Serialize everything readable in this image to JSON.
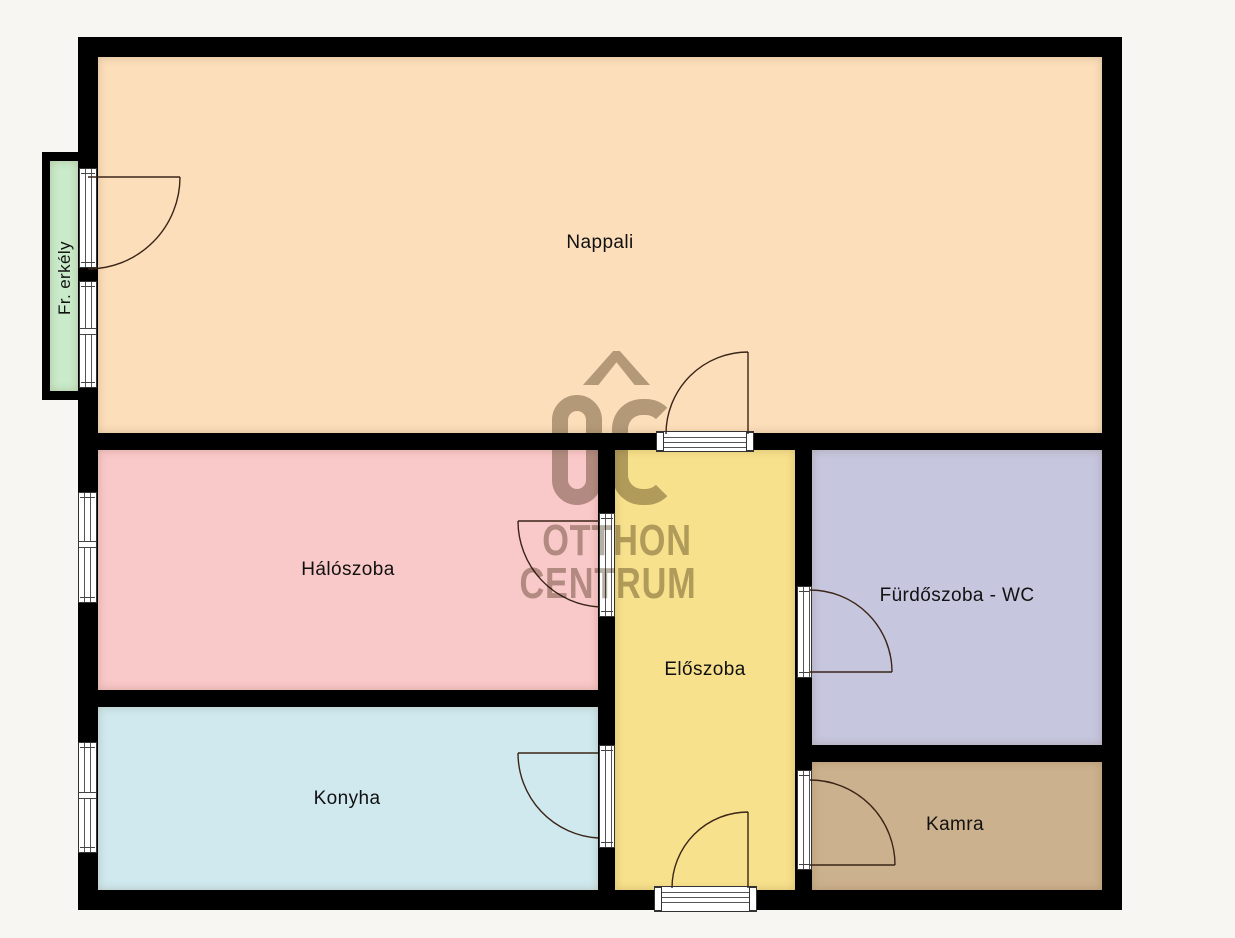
{
  "plan": {
    "type": "apartment floor plan",
    "rooms": [
      {
        "id": "nappali",
        "label": "Nappali",
        "color": "#fcdebb"
      },
      {
        "id": "haloszoba",
        "label": "Hálószoba",
        "color": "#f9c8c8"
      },
      {
        "id": "konyha",
        "label": "Konyha",
        "color": "#cfe9ef"
      },
      {
        "id": "eloszoba",
        "label": "Előszoba",
        "color": "#f7e18c"
      },
      {
        "id": "furdoszoba",
        "label": "Fürdőszoba - WC",
        "color": "#c6c6de"
      },
      {
        "id": "kamra",
        "label": "Kamra",
        "color": "#cbb18d"
      },
      {
        "id": "erkely",
        "label": "Fr. erkély",
        "color": "#c9ebc9"
      }
    ]
  },
  "watermark": {
    "logo_text": "OC",
    "line1": "OTTHON",
    "line2": "CENTRUM",
    "color": "#6d6149"
  },
  "colors": {
    "background": "#f7f6f3",
    "wall": "#000000",
    "door_line": "#3a2517",
    "window_fill": "#ffffff",
    "label_text": "#111111"
  }
}
